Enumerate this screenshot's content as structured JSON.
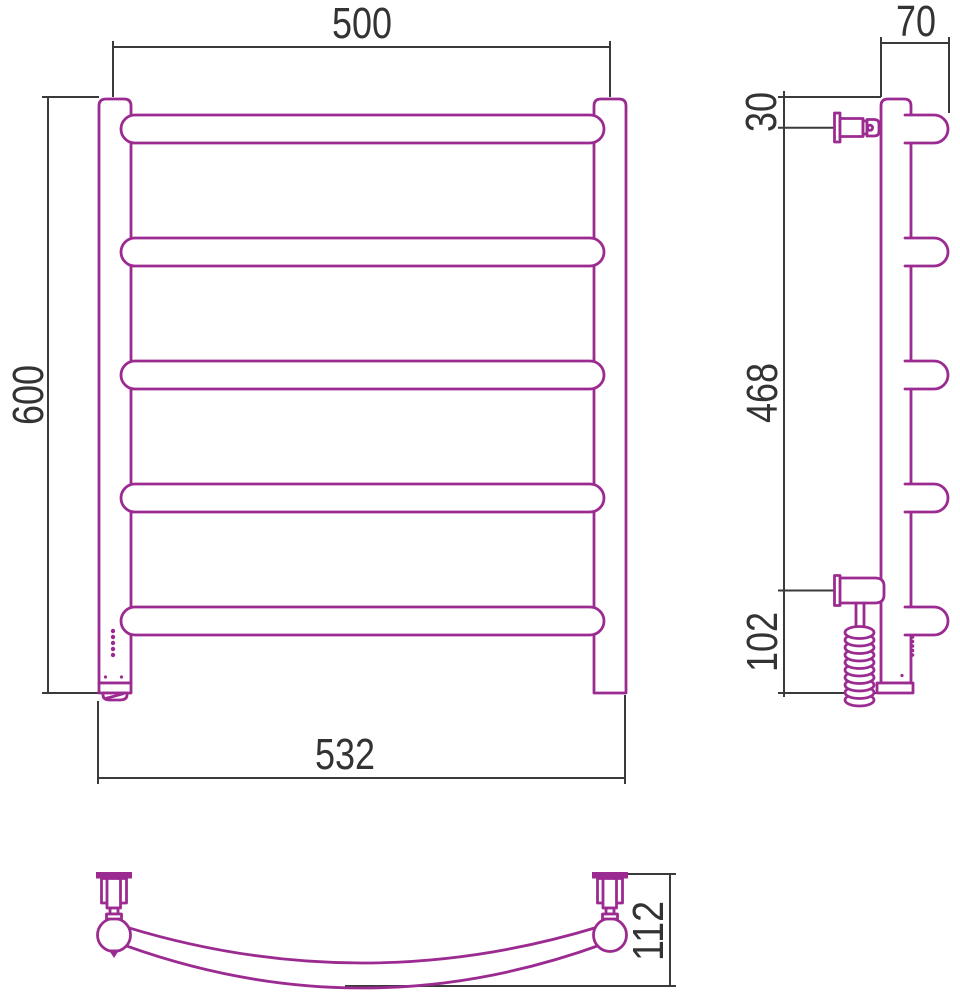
{
  "drawing": {
    "kind": "heated-towel-rail-dimension-drawing",
    "colors": {
      "outline": "#9c2b91",
      "dimension": "#3a3a3a",
      "background": "#ffffff"
    },
    "views": {
      "front": {
        "dim_width_centers": "500",
        "dim_height": "600",
        "dim_width_overall": "532"
      },
      "side": {
        "dim_depth_overall": "70",
        "dim_valve_offset": "30",
        "dim_middle_span": "468",
        "dim_bottom_span": "102"
      },
      "plan": {
        "dim_arc_depth": "112"
      }
    }
  }
}
